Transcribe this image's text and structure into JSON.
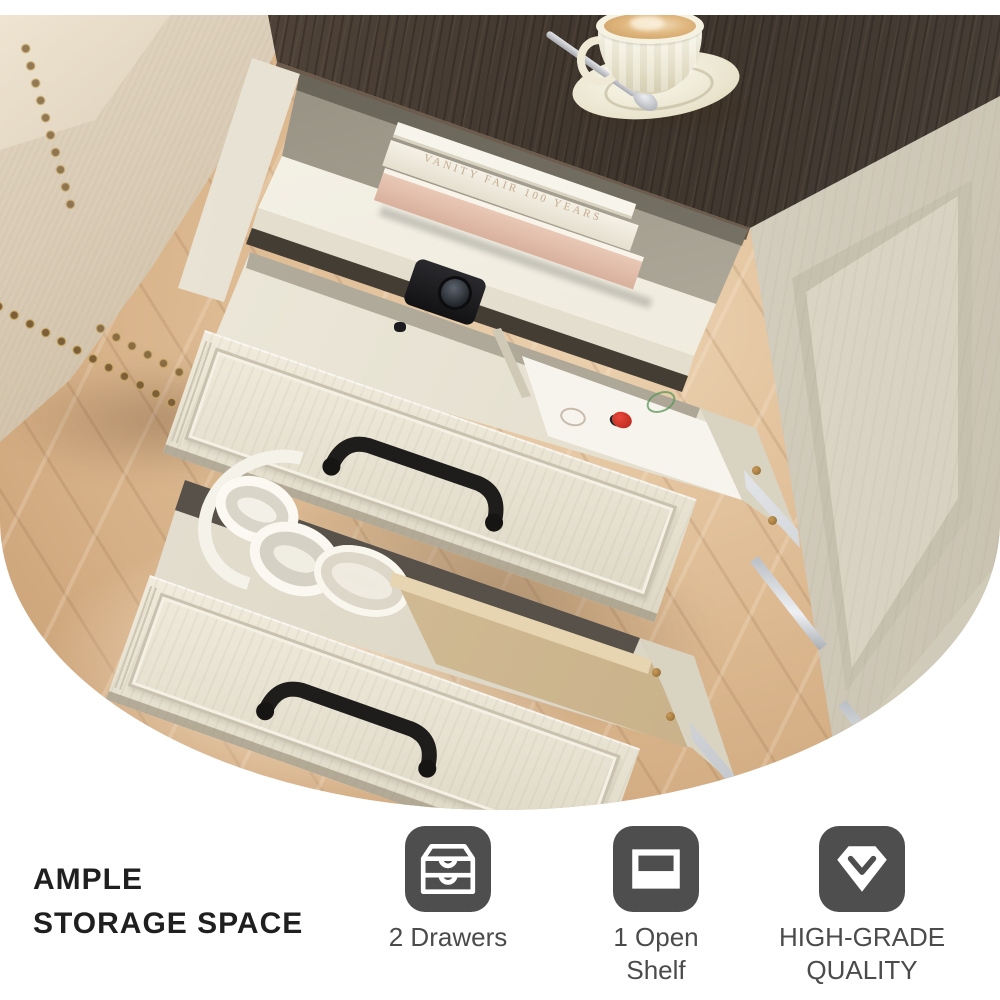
{
  "page": {
    "background": "#ffffff"
  },
  "hero": {
    "description": "White farmhouse nightstand with dark wood top, two open drawers and an open shelf, coffee cup on top, beige sofa and herringbone wood floor",
    "book_spine": "VANITY FAIR 100 YEARS",
    "objects": [
      "coffee-cup",
      "saucer",
      "spoon",
      "stacked-books",
      "camera",
      "ladybug-liner",
      "headphones",
      "plates",
      "leather-pouch",
      "sofa",
      "wood-floor",
      "wall-baseboard"
    ]
  },
  "features_section": {
    "heading": {
      "line1": "AMPLE",
      "line2": "STORAGE SPACE"
    },
    "items": [
      {
        "id": "drawers",
        "icon": "drawers-icon",
        "label": "2 Drawers"
      },
      {
        "id": "open-shelf",
        "icon": "shelf-icon",
        "label": "1 Open Shelf"
      },
      {
        "id": "quality",
        "icon": "gem-check-icon",
        "label": "HIGH-GRADE QUALITY"
      }
    ],
    "icon_bg": "#4f4e4e",
    "icon_fg": "#ffffff",
    "label_color": "#4b4b4b",
    "heading_color": "#1f1f1f"
  },
  "palette": {
    "tabletop_wood": "#443b33",
    "cabinet_white": "#e9e4d6",
    "floor_oak": "#ddba92",
    "sofa_linen": "#d6c7b0",
    "drawer_liner_tan": "#cdb68f",
    "handle_black": "#1f1d1b",
    "nailhead_brass": "#a9834b"
  }
}
